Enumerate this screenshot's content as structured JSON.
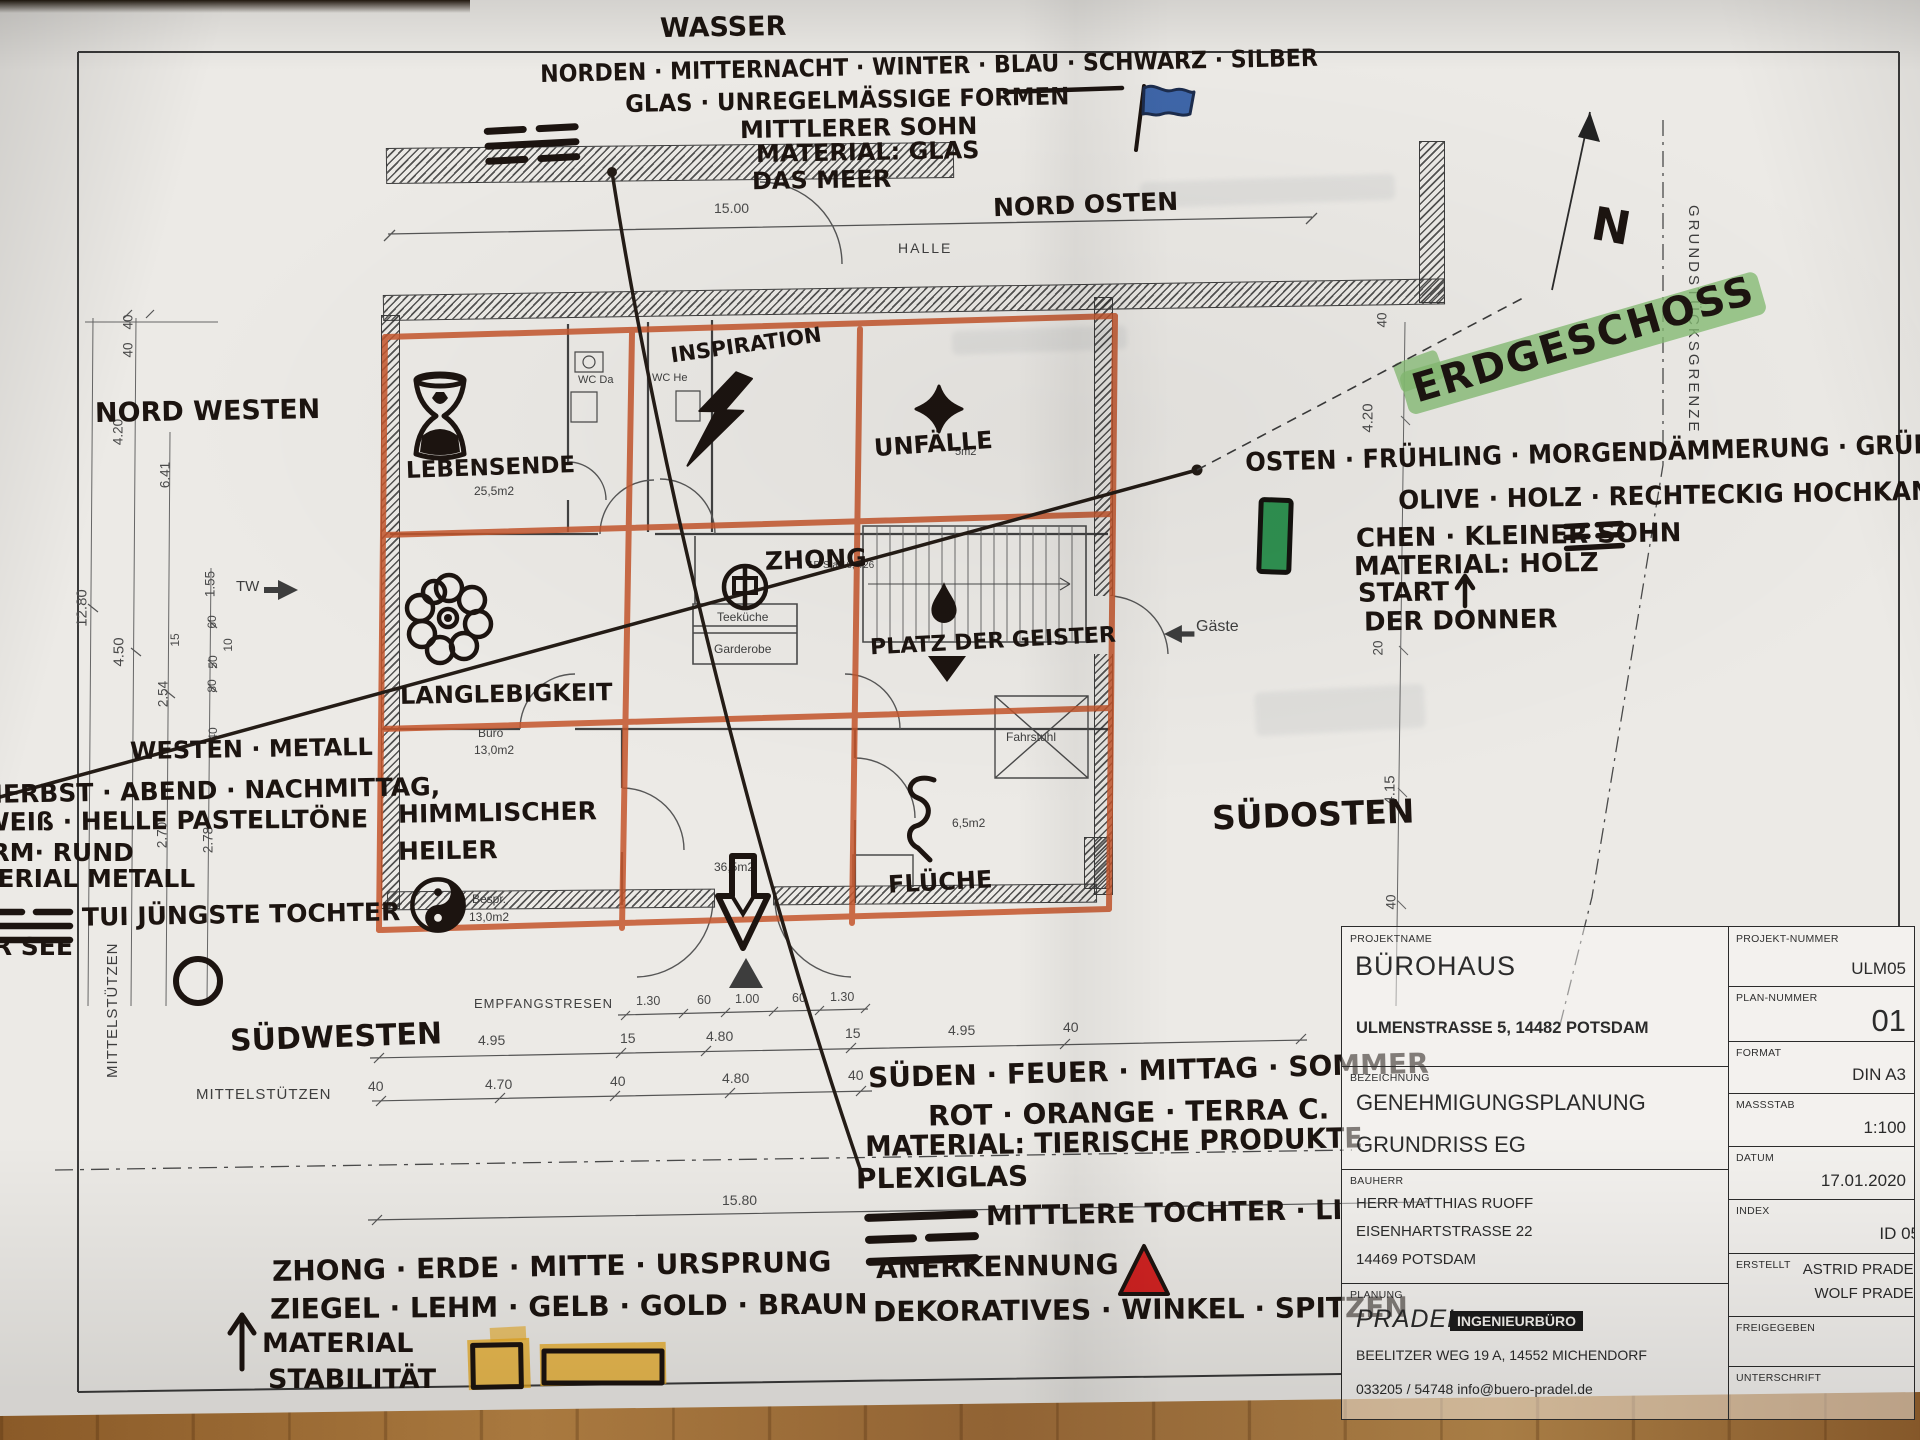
{
  "header": {
    "wasser": "WASSER",
    "norden_line": "NORDEN · MITTERNACHT · WINTER · BLAU · SCHWARZ · SILBER",
    "glas_line": "GLAS · UNREGELMÄSSIGE FORMEN",
    "mittlerer_sohn": "MITTLERER SOHN",
    "material_glas": "MATERIAL: GLAS",
    "das_meer": "DAS MEER",
    "nord_osten": "NORD OSTEN"
  },
  "east": {
    "l1": "OSTEN · FRÜHLING · MORGENDÄMMERUNG · GRÜN",
    "l2": "OLIVE · HOLZ · RECHTECKIG HOCHKANT",
    "l3": "CHEN · KLEINER SOHN",
    "l4": "MATERIAL: HOLZ",
    "l5": "START",
    "l6": "DER DONNER"
  },
  "west": {
    "l1": "WESTEN · METALL",
    "l2": "HERBST · ABEND · NACHMITTAG,",
    "l3": "WEIß · HELLE PASTELLTÖNE",
    "l4": "FORM· RUND",
    "l5": "MATERIAL METALL",
    "l6": "TUI JÜNGSTE TOCHTER",
    "l7": "DER SEE"
  },
  "south": {
    "l1": "SÜDEN · FEUER · MITTAG · SOMMER",
    "l2": "ROT · ORANGE · TERRA C.",
    "l3": "MATERIAL: TIERISCHE PRODUKTE",
    "l4": "PLEXIGLAS",
    "l5": "MITTLERE TOCHTER · LI",
    "l6": "ANERKENNUNG",
    "l7": "DEKORATIVES · WINKEL · SPITZEN"
  },
  "center": {
    "l1": "ZHONG · ERDE · MITTE · URSPRUNG",
    "l2": "ZIEGEL · LEHM · GELB · GOLD · BRAUN",
    "l3": "MATERIAL",
    "l4": "STABILITÄT"
  },
  "corners": {
    "nord_westen": "NORD WESTEN",
    "sued_westen": "SÜDWESTEN",
    "sued_osten": "SÜDOSTEN"
  },
  "compass": {
    "n": "N",
    "erdgeschoss": "ERDGESCHOSS"
  },
  "rooms_hand": {
    "lebensende": "LEBENSENDE",
    "inspiration": "INSPIRATION",
    "unfaelle": "UNFÄLLE",
    "zhong": "ZHONG",
    "langlebigkeit": "LANGLEBIGKEIT",
    "platz_der_geister": "PLATZ DER GEISTER",
    "himmlischer": "HIMMLISCHER",
    "heiler": "HEILER",
    "flueche": "FLÜCHE"
  },
  "plan_print": {
    "halle": "HALLE",
    "wc_da": "WC Da",
    "wc_he": "WC He",
    "a255": "25,5m2",
    "a5": "5m2",
    "teekueche": "Teeküche",
    "garderobe": "Garderobe",
    "buero": "Büro",
    "a13a": "13,0m2",
    "bespr": "Bespr.",
    "a13b": "13,0m2",
    "a365": "36,5m2",
    "a65": "6,5m2",
    "fahrstuhl": "Fahrstuhl",
    "stairs": "1B Sta 16,4/26",
    "gaeste": "Gäste",
    "tw": "TW",
    "empfang": "EMPFANGSTRESEN",
    "mstz_v": "MITTELSTÜTZEN",
    "mstz_h": "MITTELSTÜTZEN",
    "grenze": "GRUNDSTÜCKSGRENZE"
  },
  "dims": {
    "top": "15.00",
    "bottom": "15.80",
    "left": [
      "40",
      "40",
      "4.20",
      "6.41",
      "1.55",
      "12.80",
      "4.50",
      "15",
      "60",
      "10",
      "50",
      "80",
      "2.54",
      "40",
      "2.70",
      "2.78"
    ],
    "right": [
      "40",
      "4.20",
      "20",
      "4.15",
      "40"
    ],
    "entrance": [
      "1.30",
      "60",
      "1.00",
      "60",
      "1.30"
    ],
    "row_a": [
      "4.95",
      "15",
      "4.80",
      "15",
      "4.95",
      "40"
    ],
    "row_b": [
      "40",
      "4.70",
      "40",
      "4.80",
      "40"
    ]
  },
  "title_block": {
    "projektname_label": "PROJEKTNAME",
    "projektname": "BÜROHAUS",
    "adresse": "ULMENSTRASSE 5, 14482 POTSDAM",
    "projekt_nummer_label": "PROJEKT-NUMMER",
    "projekt_nummer": "ULM05",
    "plan_nummer_label": "PLAN-NUMMER",
    "plan_nummer": "01",
    "bezeichnung_label": "BEZEICHNUNG",
    "bezeichnung1": "GENEHMIGUNGSPLANUNG",
    "bezeichnung2": "GRUNDRISS EG",
    "format_label": "FORMAT",
    "format": "DIN A3",
    "massstab_label": "MASSSTAB",
    "massstab": "1:100",
    "bauherr_label": "BAUHERR",
    "bauherr1": "HERR MATTHIAS RUOFF",
    "bauherr2": "EISENHARTSTRASSE 22",
    "bauherr3": "14469 POTSDAM",
    "datum_label": "DATUM",
    "datum": "17.01.2020",
    "index_label": "INDEX",
    "index": "ID 05",
    "planung_label": "PLANUNG",
    "planung_name": "PRADEL",
    "planung_typ": "INGENIEURBÜRO",
    "planung_adresse": "BEELITZER WEG 19 A, 14552 MICHENDORF",
    "planung_kontakt": "033205 / 54748   info@buero-pradel.de",
    "erstellt_label": "ERSTELLT",
    "erstellt1": "ASTRID PRADEL",
    "erstellt2": "WOLF PRADEL",
    "freigegeben_label": "FREIGEGEBEN",
    "unterschrift_label": "UNTERSCHRIFT"
  },
  "colors": {
    "orange_marker": "#c5562c",
    "green_highlight": "#84bb72",
    "green_marker": "#2f9151",
    "blue_marker": "#3e66a8",
    "red_marker": "#d42322",
    "yellow_marker": "#e9a91d",
    "ink": "#1c1410"
  },
  "icons": [
    "hourglass-icon",
    "flower-icon",
    "yin-yang-icon",
    "lightning-icon",
    "cross-pattee-icon",
    "zhong-character-icon",
    "water-drop-icon",
    "triangle-down-icon",
    "curse-squiggle-icon",
    "entrance-arrow-icon",
    "entry-triangle-icon",
    "north-arrow-icon",
    "blue-flag-icon",
    "green-rectangle-icon",
    "red-triangle-icon",
    "yellow-squares-icon",
    "circle-icon",
    "trigram-kan-icon",
    "trigram-zhen-icon",
    "trigram-dui-icon",
    "trigram-li-icon",
    "start-arrow-icon",
    "stability-arrow-icon",
    "tw-arrow-icon",
    "gaeste-arrow-icon"
  ]
}
